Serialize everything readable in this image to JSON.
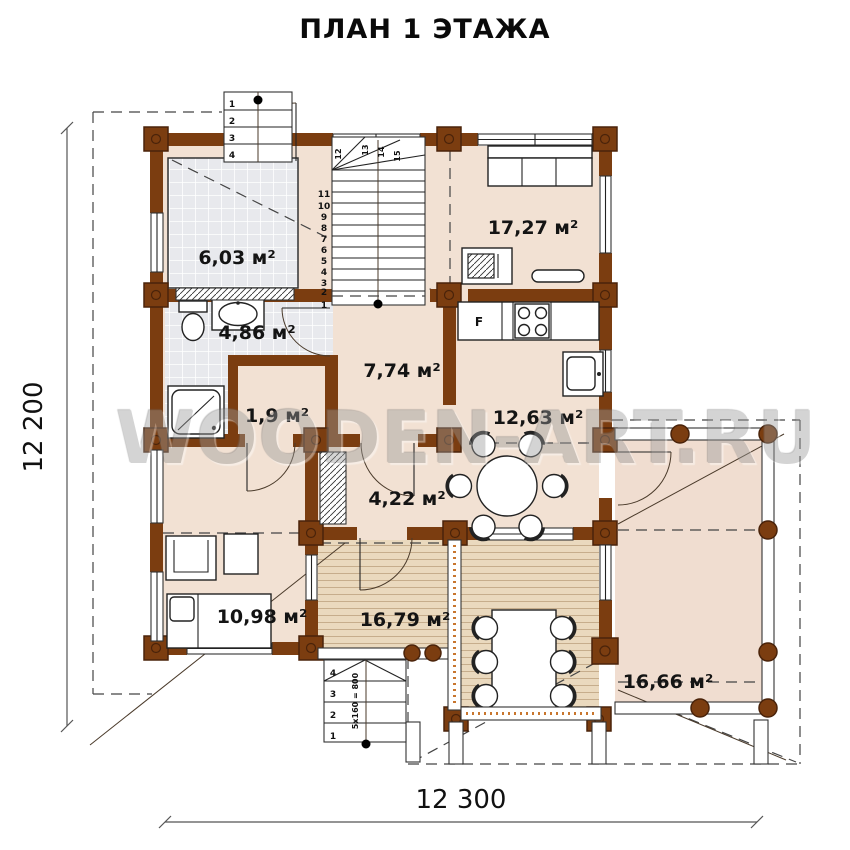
{
  "page": {
    "title": "ПЛАН 1 ЭТАЖА"
  },
  "watermark": "WOODEN-ART.RU",
  "dimensions": {
    "left": "12 200",
    "bottom": "12 300"
  },
  "rooms": [
    {
      "name": "sauna",
      "area": "6,03 м²"
    },
    {
      "name": "living",
      "area": "17,27 м²"
    },
    {
      "name": "bathroom",
      "area": "4,86 м²"
    },
    {
      "name": "hall",
      "area": "7,74 м²"
    },
    {
      "name": "closet",
      "area": "1,9 м²"
    },
    {
      "name": "kitchen",
      "area": "12,63 м²"
    },
    {
      "name": "inner-hall",
      "area": "4,22 м²"
    },
    {
      "name": "bedroom",
      "area": "10,98 м²"
    },
    {
      "name": "terrace",
      "area": "16,79 м²"
    },
    {
      "name": "veranda",
      "area": "16,66 м²"
    }
  ],
  "kitchen": {
    "fridge_label": "F"
  },
  "stairs": {
    "interior": {
      "steps": [
        "1",
        "2",
        "3",
        "4",
        "5",
        "6",
        "7",
        "8",
        "9",
        "10",
        "11"
      ],
      "landing": "12",
      "winders": [
        "13",
        "14",
        "15"
      ]
    },
    "entry": {
      "steps": [
        "1",
        "2",
        "3",
        "4"
      ]
    },
    "exterior": {
      "steps": [
        "4",
        "3",
        "2",
        "1"
      ],
      "note": "5x160 = 800"
    }
  },
  "colors": {
    "wall": "#7b3d10",
    "floor": "#f2e1d3",
    "deck": "#ead9be",
    "tile": "#e8e9ed"
  }
}
